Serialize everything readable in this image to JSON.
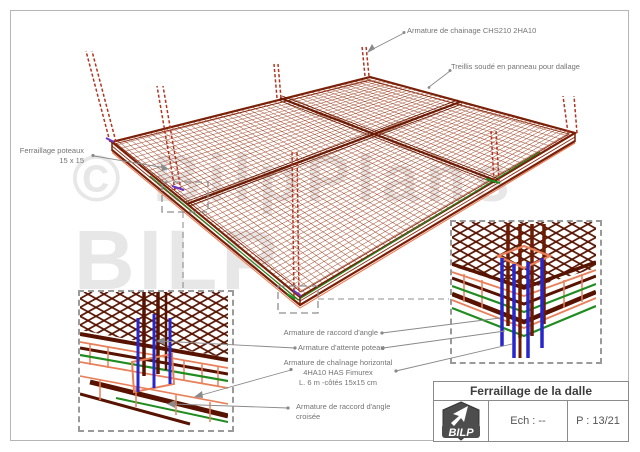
{
  "annotations": {
    "chainage_top": "Armature de chainage CHS210 2HA10",
    "treillis": "Treillis soudé en panneau pour dallage",
    "poteaux_line1": "Ferraillage poteaux",
    "poteaux_line2": "15 x 15",
    "raccord_angle": "Armature de raccord d'angle",
    "attente_poteau": "Armature d'attente poteau",
    "chainage_h1": "Armature de chaînage horizontal",
    "chainage_h2": "4HA10 HAS Fimurex",
    "chainage_h3": "L. 6 m -côtés 15x15 cm",
    "raccord_croise1": "Armature de raccord d'angle",
    "raccord_croise2": "croisée"
  },
  "title_block": {
    "title": "Ferraillage de la dalle",
    "scale_label": "Ech : --",
    "page_label": "P : 13/21",
    "logo_text": "BILP"
  },
  "watermark": {
    "line1": "© BilpPlans",
    "line2": "BILP"
  },
  "colors": {
    "mesh": "#a14a2c",
    "edge": "#7a2008",
    "beam": "#6b1a04",
    "column_dashed": "#b23420",
    "blue_bar": "#2626cc",
    "green_bar": "#1f8c1f",
    "orange_bar": "#e8805a",
    "purple_mark": "#6a35c8",
    "leader": "#8a8a8a",
    "watermark": "#e7e7e7"
  }
}
